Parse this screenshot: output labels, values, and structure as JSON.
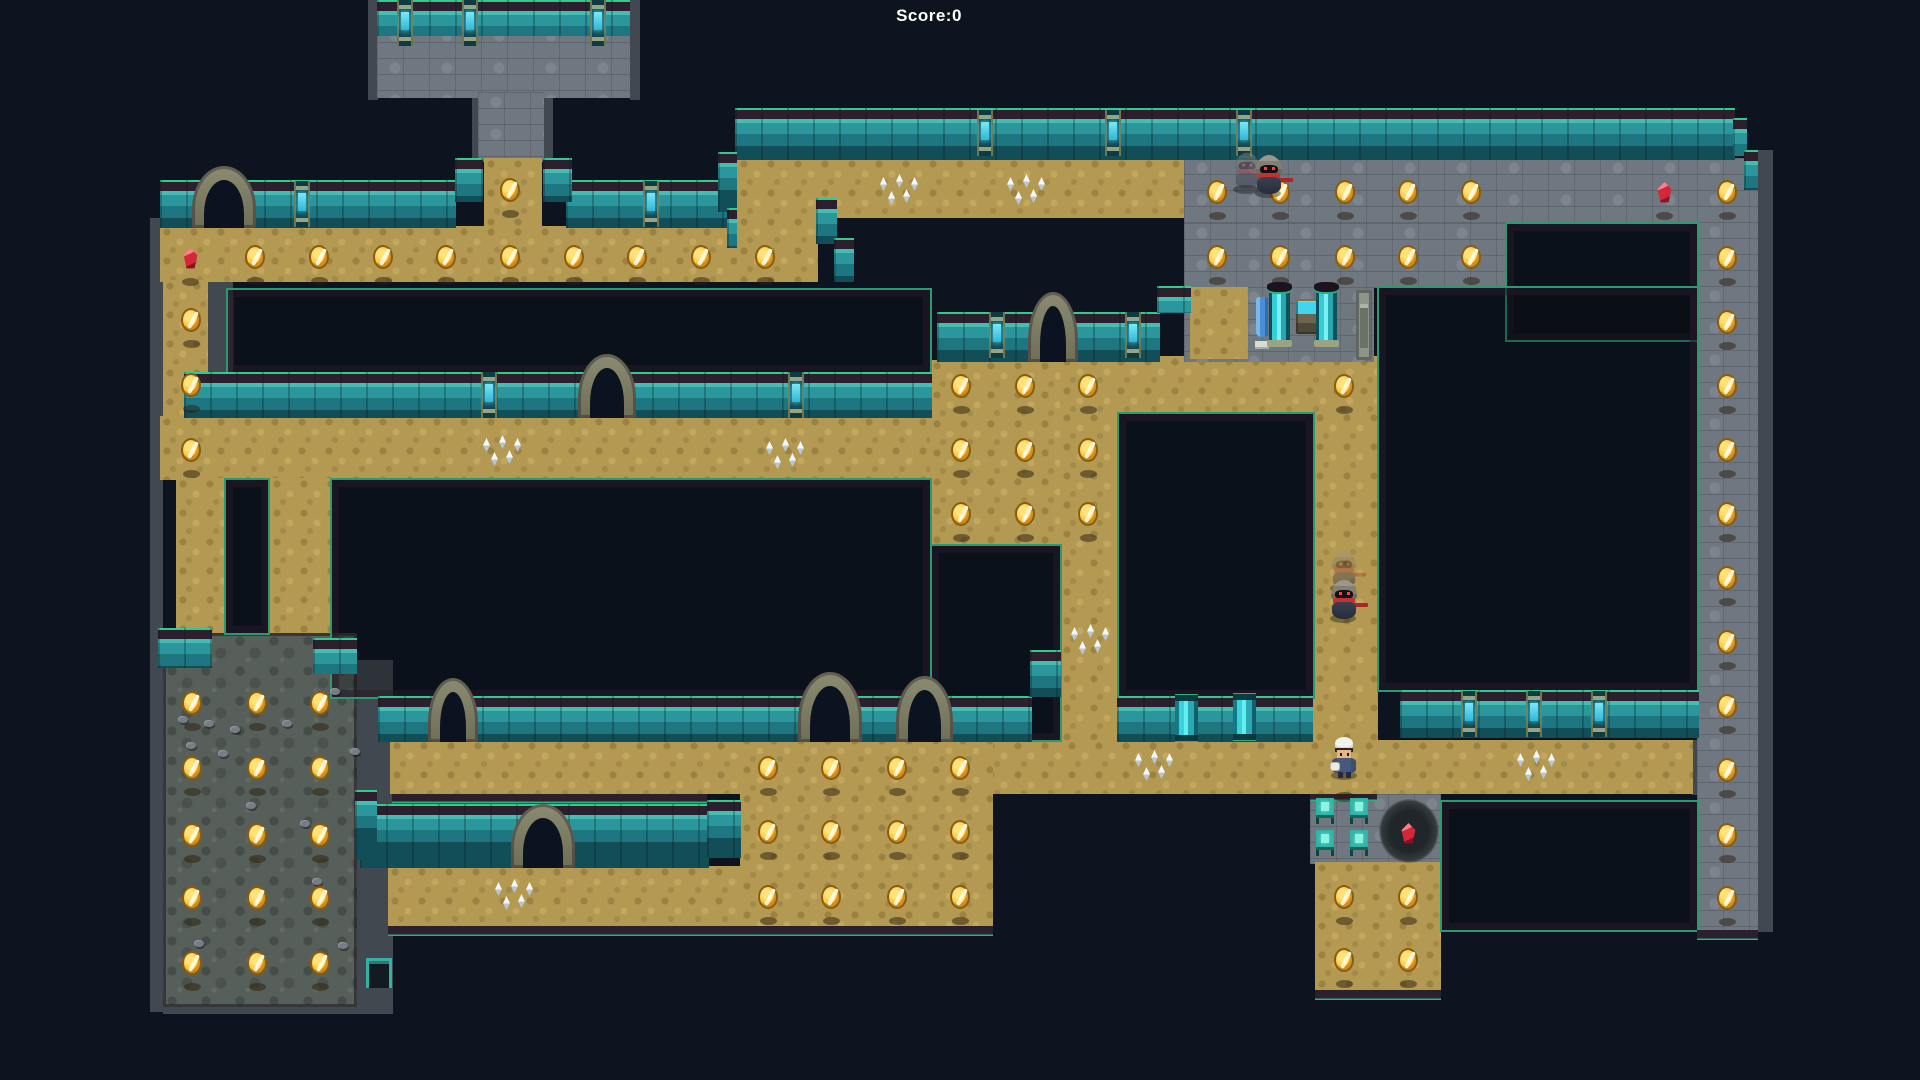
{
  "hud": {
    "score_label": "Score:0"
  },
  "palette": {
    "background": "#0d1420",
    "sand": "#b39952",
    "stone": "#6f7781",
    "dark_room": "#575f5a",
    "wall_teal": "#2b969c",
    "wall_cap": "#2c1f2e",
    "edge_green": "#2fae7c",
    "coin_gold": "#fcbf2e",
    "gem_red": "#d32839",
    "spike_white": "#f4f8fa",
    "gem_cyan": "#3fd4ea"
  },
  "map": {
    "trims": [
      [
        150,
        218,
        13,
        425
      ],
      [
        207,
        282,
        26,
        135
      ],
      [
        472,
        92,
        10,
        70
      ],
      [
        543,
        92,
        10,
        70
      ],
      [
        150,
        630,
        13,
        382
      ],
      [
        355,
        660,
        38,
        350
      ],
      [
        163,
        1005,
        230,
        9
      ],
      [
        1757,
        150,
        16,
        782
      ],
      [
        376,
        735,
        18,
        60
      ],
      [
        1692,
        740,
        7,
        55
      ],
      [
        368,
        0,
        10,
        100
      ],
      [
        630,
        0,
        10,
        100
      ]
    ],
    "floors": [
      {
        "x": 377,
        "y": 26,
        "w": 253,
        "h": 72,
        "t": "stone"
      },
      {
        "x": 478,
        "y": 92,
        "w": 66,
        "h": 70,
        "t": "stone"
      },
      {
        "x": 484,
        "y": 158,
        "w": 58,
        "h": 70,
        "t": "sand"
      },
      {
        "x": 160,
        "y": 226,
        "w": 658,
        "h": 56,
        "t": "sand"
      },
      {
        "x": 737,
        "y": 158,
        "w": 80,
        "h": 124,
        "t": "sand"
      },
      {
        "x": 737,
        "y": 158,
        "w": 447,
        "h": 60,
        "t": "sand"
      },
      {
        "x": 163,
        "y": 280,
        "w": 45,
        "h": 140,
        "t": "sand"
      },
      {
        "x": 160,
        "y": 416,
        "w": 770,
        "h": 64,
        "t": "sand"
      },
      {
        "x": 176,
        "y": 478,
        "w": 48,
        "h": 160,
        "t": "sand"
      },
      {
        "x": 270,
        "y": 478,
        "w": 60,
        "h": 160,
        "t": "sand"
      },
      {
        "x": 163,
        "y": 633,
        "w": 194,
        "h": 374,
        "t": "dark"
      },
      {
        "x": 930,
        "y": 360,
        "w": 188,
        "h": 186,
        "t": "sand"
      },
      {
        "x": 1060,
        "y": 356,
        "w": 318,
        "h": 57,
        "t": "sand"
      },
      {
        "x": 1060,
        "y": 412,
        "w": 58,
        "h": 330,
        "t": "sand"
      },
      {
        "x": 1313,
        "y": 412,
        "w": 65,
        "h": 382,
        "t": "sand"
      },
      {
        "x": 1184,
        "y": 158,
        "w": 561,
        "h": 66,
        "t": "stone"
      },
      {
        "x": 1184,
        "y": 223,
        "w": 322,
        "h": 65,
        "t": "stone"
      },
      {
        "x": 1184,
        "y": 287,
        "w": 190,
        "h": 75,
        "t": "stone"
      },
      {
        "x": 1190,
        "y": 287,
        "w": 58,
        "h": 72,
        "t": "sand"
      },
      {
        "x": 1697,
        "y": 158,
        "w": 61,
        "h": 772,
        "t": "stone"
      },
      {
        "x": 390,
        "y": 740,
        "w": 1303,
        "h": 54,
        "t": "sand"
      },
      {
        "x": 740,
        "y": 735,
        "w": 253,
        "h": 191,
        "t": "sand"
      },
      {
        "x": 388,
        "y": 866,
        "w": 354,
        "h": 60,
        "t": "sand"
      },
      {
        "x": 1310,
        "y": 794,
        "w": 131,
        "h": 70,
        "t": "stone"
      },
      {
        "x": 1315,
        "y": 862,
        "w": 126,
        "h": 130,
        "t": "sand"
      }
    ],
    "holes": [
      [
        226,
        288,
        706,
        86
      ],
      [
        224,
        478,
        46,
        157
      ],
      [
        330,
        478,
        602,
        221
      ],
      [
        930,
        544,
        132,
        198
      ],
      [
        1117,
        412,
        198,
        287
      ],
      [
        1505,
        222,
        194,
        120
      ],
      [
        1377,
        286,
        322,
        406
      ],
      [
        1440,
        800,
        259,
        132
      ]
    ],
    "walls": [
      [
        377,
        0,
        253,
        36
      ],
      [
        160,
        180,
        296,
        48
      ],
      [
        566,
        180,
        166,
        48
      ],
      [
        184,
        372,
        748,
        46
      ],
      [
        937,
        312,
        223,
        50
      ],
      [
        735,
        108,
        1000,
        52
      ],
      [
        378,
        696,
        654,
        46
      ],
      [
        1117,
        696,
        196,
        46
      ],
      [
        1400,
        690,
        299,
        48
      ],
      [
        360,
        804,
        349,
        64
      ],
      [
        158,
        628,
        54,
        40
      ],
      [
        313,
        638,
        44,
        36
      ],
      [
        455,
        158,
        28,
        44
      ],
      [
        543,
        158,
        29,
        44
      ]
    ],
    "steps": [
      [
        718,
        152,
        19,
        60
      ],
      [
        727,
        208,
        10,
        40
      ],
      [
        816,
        198,
        21,
        46
      ],
      [
        834,
        238,
        20,
        44
      ],
      [
        1733,
        118,
        14,
        38
      ],
      [
        1744,
        150,
        14,
        40
      ],
      [
        1157,
        286,
        34,
        27
      ],
      [
        1030,
        650,
        31,
        47
      ],
      [
        707,
        800,
        34,
        58
      ],
      [
        355,
        790,
        22,
        70
      ]
    ],
    "caps": [
      [
        388,
        926,
        605,
        12
      ],
      [
        392,
        794,
        315,
        11
      ],
      [
        1315,
        990,
        126,
        12
      ],
      [
        1697,
        930,
        61,
        12
      ],
      [
        1310,
        794,
        67,
        8
      ]
    ],
    "arches": [
      [
        192,
        166,
        64,
        62
      ],
      [
        578,
        354,
        58,
        64
      ],
      [
        1028,
        292,
        50,
        70
      ],
      [
        428,
        678,
        50,
        64
      ],
      [
        798,
        672,
        64,
        70
      ],
      [
        896,
        676,
        57,
        66
      ],
      [
        511,
        804,
        64,
        64
      ]
    ],
    "pillars": [
      [
        397,
        0
      ],
      [
        462,
        0
      ],
      [
        590,
        0
      ],
      [
        294,
        181
      ],
      [
        643,
        181
      ],
      [
        481,
        372
      ],
      [
        788,
        372
      ],
      [
        989,
        312
      ],
      [
        1125,
        312
      ],
      [
        977,
        110
      ],
      [
        1105,
        110
      ],
      [
        1236,
        110
      ],
      [
        1461,
        691
      ],
      [
        1526,
        691
      ],
      [
        1591,
        691
      ]
    ],
    "columns": [
      [
        1233,
        694
      ],
      [
        1175,
        695
      ]
    ],
    "objects": [
      {
        "t": "banner",
        "x": 1255,
        "y": 291
      },
      {
        "t": "tank",
        "x": 1269,
        "y": 284
      },
      {
        "t": "altar",
        "x": 1296,
        "y": 299
      },
      {
        "t": "tank",
        "x": 1316,
        "y": 284
      },
      {
        "t": "gdoor",
        "x": 1356,
        "y": 290
      },
      {
        "t": "exit",
        "x": 366,
        "y": 958
      },
      {
        "t": "dcircle",
        "x": 1379,
        "y": 799
      }
    ],
    "chairs": [
      [
        1316,
        798
      ],
      [
        1350,
        798
      ],
      [
        1316,
        830
      ],
      [
        1350,
        830
      ]
    ],
    "coins": [
      [
        255,
        257
      ],
      [
        319,
        257
      ],
      [
        383,
        257
      ],
      [
        446,
        257
      ],
      [
        510,
        257
      ],
      [
        574,
        257
      ],
      [
        637,
        257
      ],
      [
        701,
        257
      ],
      [
        765,
        257
      ],
      [
        510,
        190
      ],
      [
        191,
        320
      ],
      [
        191,
        385
      ],
      [
        191,
        450
      ],
      [
        1217,
        192
      ],
      [
        1280,
        192
      ],
      [
        1345,
        192
      ],
      [
        1408,
        192
      ],
      [
        1471,
        192
      ],
      [
        1217,
        257
      ],
      [
        1280,
        257
      ],
      [
        1345,
        257
      ],
      [
        1408,
        257
      ],
      [
        1471,
        257
      ],
      [
        1727,
        192
      ],
      [
        1727,
        258
      ],
      [
        1727,
        322
      ],
      [
        1727,
        386
      ],
      [
        1727,
        450
      ],
      [
        1727,
        514
      ],
      [
        1727,
        578
      ],
      [
        1727,
        642
      ],
      [
        1727,
        706
      ],
      [
        1727,
        770
      ],
      [
        1727,
        835
      ],
      [
        1727,
        898
      ],
      [
        961,
        386
      ],
      [
        1025,
        386
      ],
      [
        1088,
        386
      ],
      [
        961,
        450
      ],
      [
        1025,
        450
      ],
      [
        1088,
        450
      ],
      [
        961,
        514
      ],
      [
        1025,
        514
      ],
      [
        1088,
        514
      ],
      [
        1344,
        386
      ],
      [
        192,
        703
      ],
      [
        257,
        703
      ],
      [
        320,
        703
      ],
      [
        192,
        768
      ],
      [
        257,
        768
      ],
      [
        320,
        768
      ],
      [
        192,
        835
      ],
      [
        257,
        835
      ],
      [
        320,
        835
      ],
      [
        192,
        898
      ],
      [
        257,
        898
      ],
      [
        320,
        898
      ],
      [
        192,
        963
      ],
      [
        257,
        963
      ],
      [
        320,
        963
      ],
      [
        768,
        768
      ],
      [
        831,
        768
      ],
      [
        897,
        768
      ],
      [
        960,
        768
      ],
      [
        768,
        832
      ],
      [
        831,
        832
      ],
      [
        897,
        832
      ],
      [
        960,
        832
      ],
      [
        768,
        897
      ],
      [
        831,
        897
      ],
      [
        897,
        897
      ],
      [
        960,
        897
      ],
      [
        1344,
        897
      ],
      [
        1408,
        897
      ],
      [
        1344,
        960
      ],
      [
        1408,
        960
      ]
    ],
    "gems": [
      [
        190,
        258
      ],
      [
        1664,
        192
      ],
      [
        1408,
        833
      ]
    ],
    "spikes": [
      [
        897,
        192
      ],
      [
        1024,
        192
      ],
      [
        500,
        453
      ],
      [
        783,
        456
      ],
      [
        1088,
        642
      ],
      [
        1152,
        768
      ],
      [
        1534,
        768
      ],
      [
        512,
        897
      ]
    ],
    "rocks": [
      [
        178,
        716
      ],
      [
        204,
        720
      ],
      [
        230,
        726
      ],
      [
        186,
        742
      ],
      [
        282,
        720
      ],
      [
        330,
        688
      ],
      [
        218,
        750
      ],
      [
        246,
        802
      ],
      [
        350,
        748
      ],
      [
        312,
        878
      ],
      [
        194,
        940
      ],
      [
        338,
        942
      ],
      [
        300,
        820
      ]
    ],
    "extra_spots": [
      [
        1344,
        792
      ]
    ],
    "characters": [
      {
        "t": "ghost",
        "x": 1268,
        "y": 175,
        "trail": {
          "dx": -22,
          "dy": -4
        }
      },
      {
        "t": "ghost",
        "x": 1343,
        "y": 600,
        "trail": {
          "dx": 0,
          "dy": -30
        }
      },
      {
        "t": "player",
        "x": 1344,
        "y": 757
      }
    ]
  }
}
